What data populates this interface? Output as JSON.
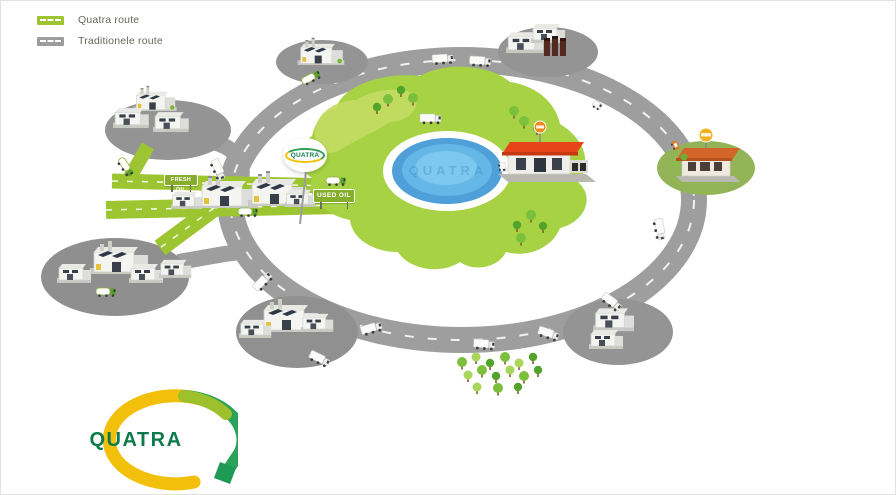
{
  "legend": {
    "items": [
      {
        "id": "quatra-route",
        "label": "Quatra route",
        "road_color": "#9cc531"
      },
      {
        "id": "traditionele-route",
        "label": "Traditionele route",
        "road_color": "#9c9c9c"
      }
    ]
  },
  "illustration": {
    "balloon_sign_text": "QUATRA",
    "fresh_oil_sign_text": "FRESH OIL",
    "used_oil_sign_text": "USED OIL",
    "lake_watermark_text": "QUATRA"
  },
  "logo": {
    "wordmark": "QUATRA"
  },
  "colors": {
    "quatra_green": "#9cc531",
    "field_green": "#a6d243",
    "road_gray": "#9e9e9e",
    "pad_gray": "#949494",
    "lake_blue": "#57b3e3",
    "restaurant_red_roof": "#e8441a",
    "restaurant_orange_roof": "#d4652a",
    "logo_yellow": "#f2bf0a",
    "logo_green": "#2aa257",
    "wordmark_green": "#0c7a4b"
  }
}
